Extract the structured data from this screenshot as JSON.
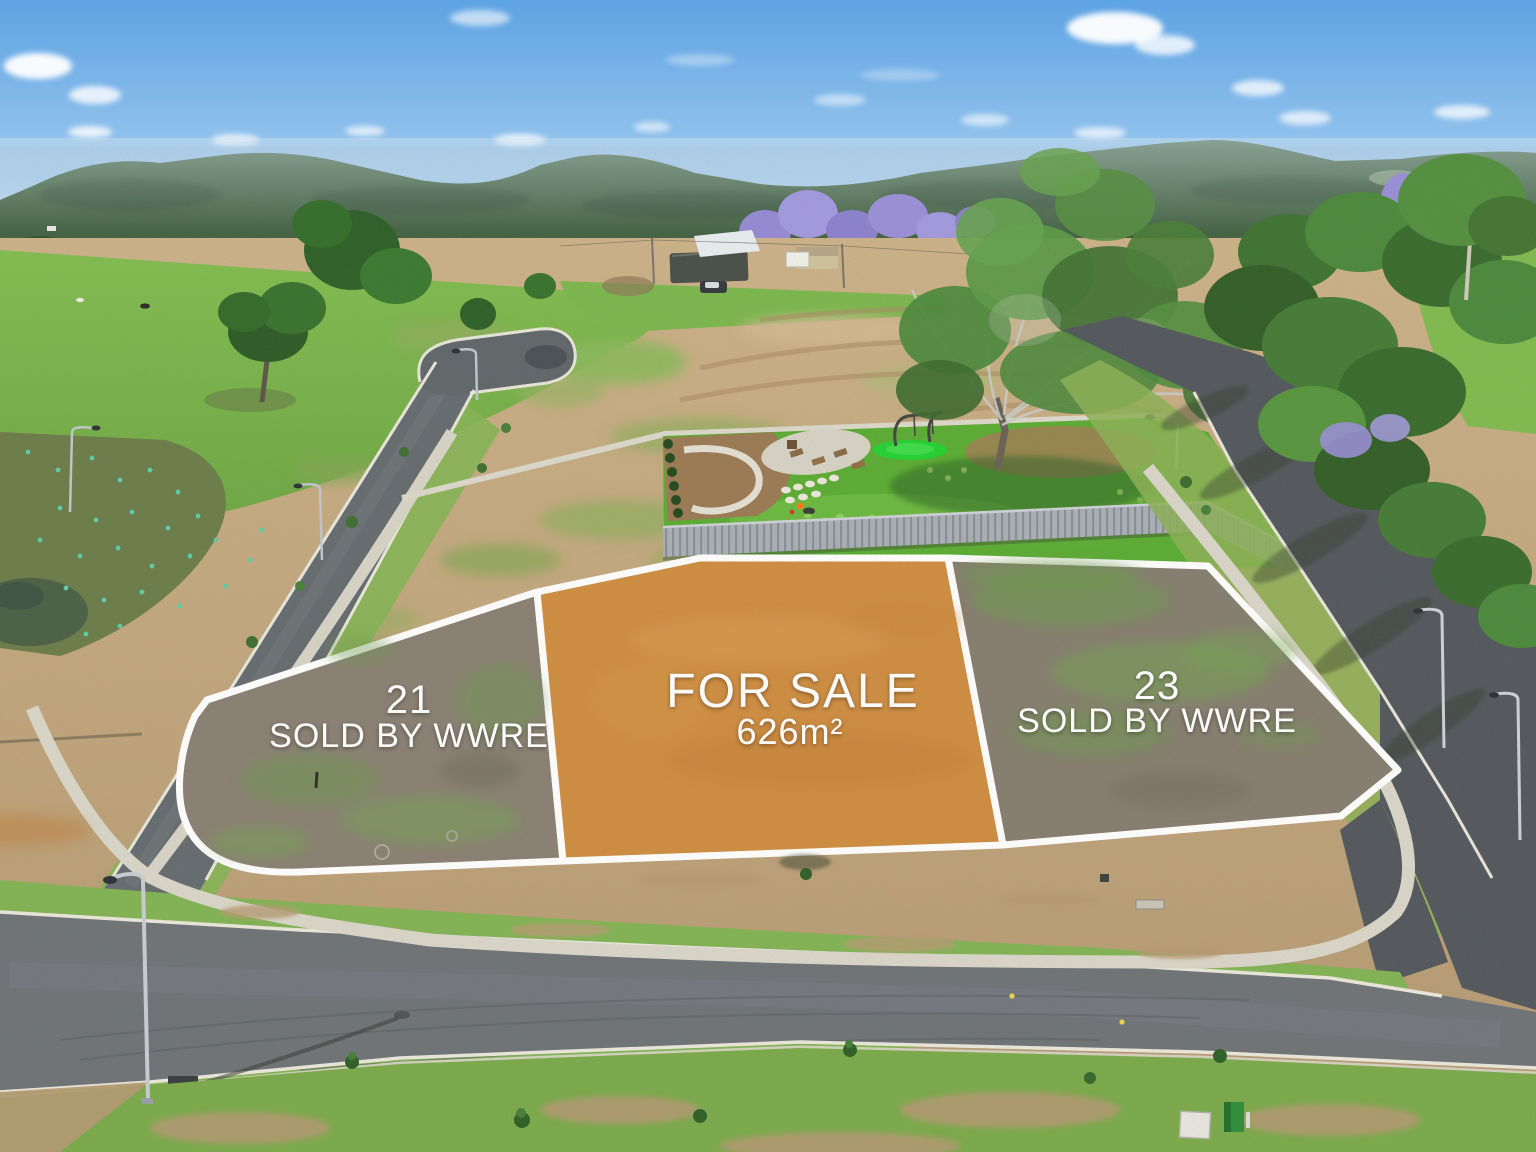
{
  "photo": {
    "type": "aerial-drone-photograph",
    "subject": "Residential land estate with park, roads and surveyed lots"
  },
  "lots": {
    "left": {
      "number": "21",
      "status": "SOLD BY WWRE"
    },
    "center": {
      "headline": "FOR SALE",
      "area": "626m²"
    },
    "right": {
      "number": "23",
      "status": "SOLD BY WWRE"
    }
  },
  "colors": {
    "for_sale_fill": "#cf8e42",
    "sold_fill": "#8a8174",
    "sold_fill_right": "#867e70",
    "boundary": "#ffffff",
    "label_text": "#ffffff",
    "asphalt": "#6f7478",
    "park_lawn": "#5cad35",
    "play_circle": "#25d233",
    "sky_top": "#5ea3e3"
  }
}
